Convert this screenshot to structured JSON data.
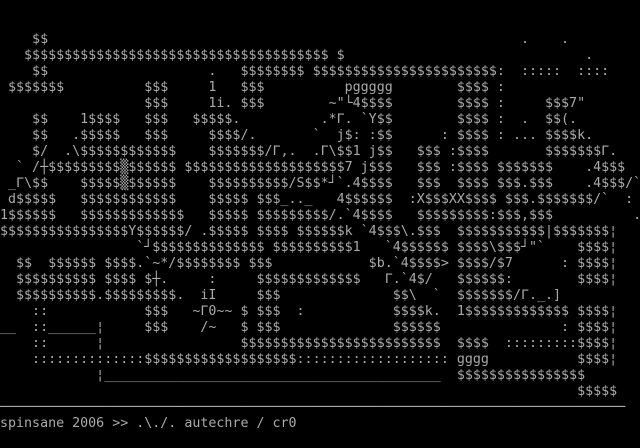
{
  "terminal": {
    "columns": 80,
    "rows": 28,
    "foreground": "#aaaaaa",
    "background": "#000000",
    "art_lines": [
      "",
      "",
      "    $$                                                           .    .",
      "   $$$$$$$$$$$$$$$$$$$$$$$$$$$$$$$$$$$$$$ $                              .",
      "    $$                    .   $$$$$$$$ $$$$$$$$$$$$$$$$$$$$$$$:  :::::  ::::",
      " $$$$$$$          $$$     1   $$$          pggggg        $$$$ :",
      "                  $$$     1i. $$$        ~\"└4$$$$        $$$$ :     $$$7\"",
      "    $$    1$$$$   $$$   $$$$$.          .*Γ. `Y$$        $$$$ :  .  $$(.",
      "    $$   .$$$$$   $$$     $$$$/.       `  j$: :$$      : $$$$ : ... $$$$k.",
      "    $/  .\\$$$$$$$$$$$$    $$$$$$$/Γ,.  .Γ\\$$1 j$$   $$$ :$$$$       $$$$$$$Γ.",
      "  ` /┼$$$$$$$$$▒$$$$$$ $$$$$$$$$$$$$$$$$$$$7 j$$$   $$$ :$$$$ $$$$$$$    .4$$$",
      " _Γ\\$$    $$$$$▒$$$$$$    $$$$$$$$$$/S$$*┘`.4$$$$   $$$  $$$$ $$$.$$$    .4$$$/`",
      " d$$$$$   $$$$$$$$$$$$    $$$$$ $$$_.._   4$$$$$$  :X$$$XX$$$$ $$$.$$$$$$$/`  :",
      "1$$$$$$   $$$$$$$$$$$$$   $$$$$ $$$$$$$$$/.`4$$$$   $$$$$$$$$:$$$,$$$          .",
      "$$$$$$$$$$$$$$$$Y$$$$$$/ .$$$$$ $$$$ $$$$$$k `4$$$\\.$$$  $$$$$$$$$$$|$$$$$$$¦",
      "                 `┘$$$$$$$$$$$$$$ $$$$$$$$$$1   `4$$$$$$ $$$$\\$$$┘\"`    $$$$¦",
      "  $$  $$$$$$ $$$$.`~*/$$$$$$$$ $$$            $b.`4$$$$> $$$$/$7      : $$$$¦",
      "  $$$$$$$$$$ $$$$ $┼.     :     $$$$$$$$$$$$$   Γ.`4$/   $$$$$$:        $$$$¦",
      "  $$$$$$$$$$.$$$$$$$$$.  iI     $$$              $$\\  `  $$$$$$$/Γ._.]",
      "    ::            $$$   ~Γ0~~ $ $$$  :           $$$$k.  1$$$$$$$$$$$$$ $$$$¦",
      "__  ::______¦     $$$    /~   $ $$$              $$$$$$               : $$$$¦",
      "    ::      ¦                 $$$$$$$$$$$$$$$$$$$$$$$$$  $$$$  :::::::::$$$$¦",
      "    ::::::::::::::$$$$$$$$$$$$$$$$$$$::::::::::::::::::: gggg           $$$$¦",
      "            ¦__________________________________________  $$$$$$$$$$$$$$$$",
      "                                                                        $$$$$",
      "──────────────────────────────────────────────────────────────────────────────"
    ],
    "status_line": "spinsane 2006 >> .\\./. autechre / cr0"
  }
}
